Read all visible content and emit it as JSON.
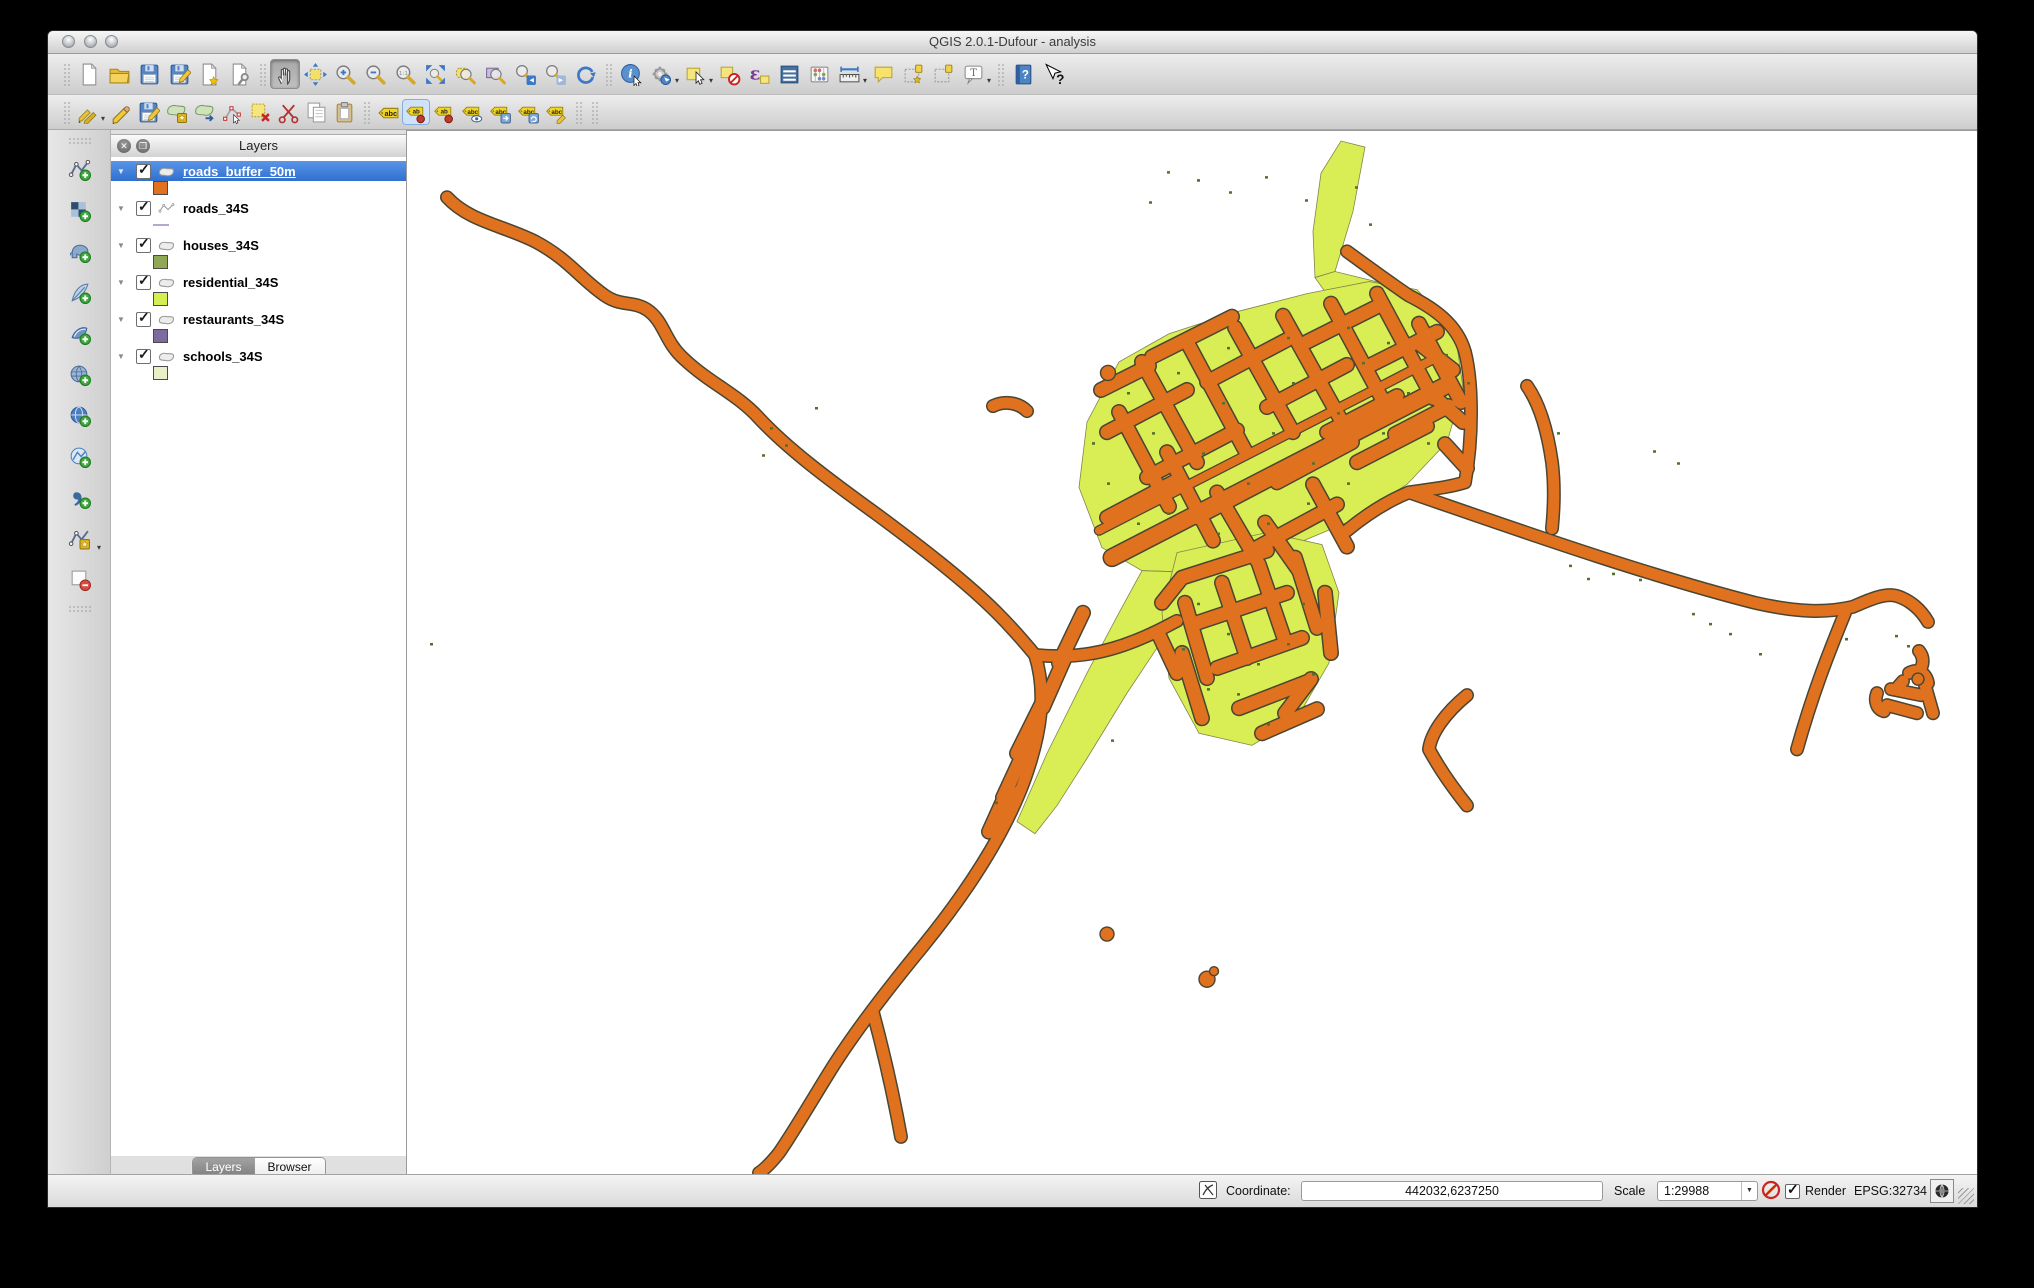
{
  "window": {
    "title": "QGIS 2.0.1-Dufour - analysis"
  },
  "colors": {
    "buffer_orange": "#e0711e",
    "road_outline": "#4a4632",
    "residential_green": "#d9ee55",
    "house_green": "#55702c",
    "selection_blue": "#3d7ce0"
  },
  "toolbars": {
    "file": [
      "new-project",
      "open-project",
      "save-project",
      "save-project-as",
      "new-print-composer",
      "composer-manager"
    ],
    "navigation": [
      "touch-pan",
      "pan-to-selection",
      "zoom-in",
      "zoom-out",
      "zoom-native",
      "zoom-full",
      "zoom-to-selection",
      "zoom-to-layer",
      "zoom-last",
      "zoom-next",
      "refresh-map"
    ],
    "attributes": [
      "identify-features",
      "run-feature-action",
      "select-features",
      "deselect-features",
      "select-by-expression",
      "open-attribute-table",
      "field-calculator",
      "measure-line",
      "map-tips",
      "new-bookmark",
      "show-bookmarks",
      "text-annotation",
      "help-contents",
      "whats-this"
    ],
    "digitizing": [
      "current-edits",
      "toggle-editing",
      "save-layer-edits",
      "add-feature",
      "move-feature",
      "node-tool",
      "delete-selected",
      "cut-features",
      "copy-features",
      "paste-features"
    ],
    "labeling": [
      "labeling",
      "pin-unpin-labels",
      "highlight-pinned-labels",
      "show-hide-labels",
      "move-label",
      "rotate-label",
      "change-label"
    ],
    "manage_layers": [
      "add-vector-layer",
      "add-raster-layer",
      "add-postgis-layer",
      "add-spatialite-layer",
      "add-mssql-layer",
      "add-oracle-layer",
      "add-wms-layer",
      "add-wfs-layer",
      "add-delimited-text-layer",
      "new-shapefile-layer",
      "remove-layer"
    ]
  },
  "layers_panel": {
    "title": "Layers",
    "layers": [
      {
        "name": "roads_buffer_50m",
        "checked": true,
        "selected": true,
        "type": "polygon",
        "swatch": "#e0711e"
      },
      {
        "name": "roads_34S",
        "checked": true,
        "selected": false,
        "type": "line",
        "swatch": "#b6a6d0"
      },
      {
        "name": "houses_34S",
        "checked": true,
        "selected": false,
        "type": "polygon",
        "swatch": "#90a755"
      },
      {
        "name": "residential_34S",
        "checked": true,
        "selected": false,
        "type": "polygon",
        "swatch": "#d7ee52"
      },
      {
        "name": "restaurants_34S",
        "checked": true,
        "selected": false,
        "type": "polygon",
        "swatch": "#7c6b9f"
      },
      {
        "name": "schools_34S",
        "checked": true,
        "selected": false,
        "type": "polygon",
        "swatch": "#e9efc6"
      }
    ],
    "tabs": [
      {
        "label": "Layers",
        "active": true
      },
      {
        "label": "Browser",
        "active": false
      }
    ]
  },
  "statusbar": {
    "coordinate_label": "Coordinate:",
    "coordinate_value": "442032,6237250",
    "scale_label": "Scale",
    "scale_value": "1:29988",
    "render_label": "Render",
    "render_checked": true,
    "crs_label": "EPSG:32734"
  }
}
